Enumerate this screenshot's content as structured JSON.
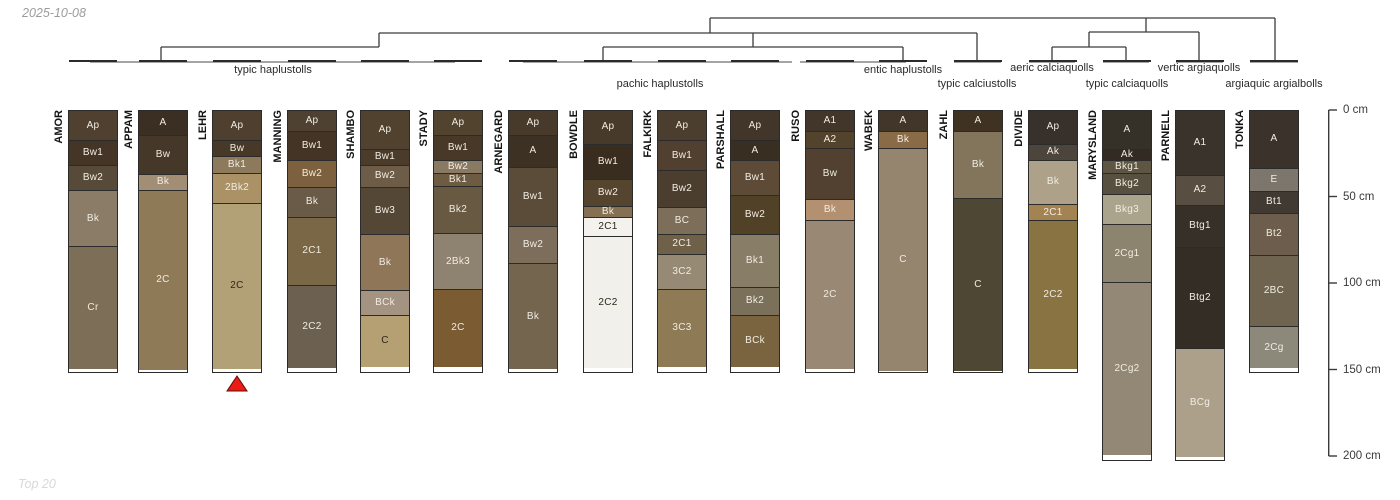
{
  "meta": {
    "date": "2025-10-08",
    "footer": "Top 20"
  },
  "marker": {
    "profile": "LEHR",
    "fill": "#ea1c13",
    "stroke": "#600d05"
  },
  "dendrogram": {
    "line_color": "#3c3c3c",
    "bracket_color": "#858585",
    "leaf_tick_color": "#2b2b2b",
    "labels": [
      {
        "text": "typic haplustolls",
        "x": 273,
        "y": 64
      },
      {
        "text": "pachic haplustolls",
        "x": 660,
        "y": 78
      },
      {
        "text": "entic haplustolls",
        "x": 903,
        "y": 64
      },
      {
        "text": "typic calciustolls",
        "x": 977,
        "y": 78
      },
      {
        "text": "aeric calciaquolls",
        "x": 1052,
        "y": 62
      },
      {
        "text": "typic calciaquolls",
        "x": 1127,
        "y": 78
      },
      {
        "text": "vertic argiaquolls",
        "x": 1199,
        "y": 62
      },
      {
        "text": "argiaquic argialbolls",
        "x": 1274,
        "y": 78
      }
    ],
    "segments": [
      [
        161,
        61,
        161,
        47
      ],
      [
        161,
        47,
        379,
        47
      ],
      [
        379,
        47,
        379,
        33
      ],
      [
        379,
        33,
        977,
        33
      ],
      [
        710,
        33,
        710,
        18
      ],
      [
        710,
        18,
        1275,
        18
      ],
      [
        1275,
        18,
        1275,
        61
      ],
      [
        603,
        61,
        603,
        47
      ],
      [
        603,
        47,
        903,
        47
      ],
      [
        903,
        47,
        903,
        61
      ],
      [
        753,
        47,
        753,
        33
      ],
      [
        977,
        33,
        977,
        61
      ],
      [
        1146,
        32,
        1146,
        18
      ],
      [
        1089,
        32,
        1199,
        32
      ],
      [
        1089,
        47,
        1089,
        32
      ],
      [
        1052,
        47,
        1126,
        47
      ],
      [
        1052,
        47,
        1052,
        61
      ],
      [
        1126,
        47,
        1126,
        61
      ],
      [
        1199,
        32,
        1199,
        61
      ]
    ],
    "brackets": [
      [
        90,
        455
      ],
      [
        523,
        792
      ],
      [
        800,
        906
      ],
      [
        954,
        1001
      ],
      [
        1029,
        1075
      ],
      [
        1103,
        1149
      ],
      [
        1176,
        1223
      ],
      [
        1250,
        1298
      ]
    ]
  },
  "chart_data": {
    "type": "table",
    "title": "Soil profile sketches grouped by taxonomic subgroup",
    "depth_unit": "cm",
    "depth_axis": {
      "x": 1328,
      "ticks": [
        0,
        50,
        100,
        150,
        200
      ],
      "tick_labels": [
        "0 cm",
        "50 cm",
        "100 cm",
        "150 cm",
        "200 cm"
      ],
      "max": 200
    },
    "profiles": [
      {
        "name": "AMOR",
        "x": 68,
        "taxon": "typic haplustolls",
        "horizons": [
          {
            "name": "Ap",
            "top": 0,
            "bottom": 18,
            "color": "#504030"
          },
          {
            "name": "Bw1",
            "top": 18,
            "bottom": 33,
            "color": "#453526"
          },
          {
            "name": "Bw2",
            "top": 33,
            "bottom": 48,
            "color": "#584a38"
          },
          {
            "name": "Bk",
            "top": 48,
            "bottom": 81,
            "color": "#8a7c66"
          },
          {
            "name": "Cr",
            "top": 81,
            "bottom": 152,
            "color": "#7d6e57"
          }
        ]
      },
      {
        "name": "APPAM",
        "x": 138,
        "taxon": "typic haplustolls",
        "horizons": [
          {
            "name": "A",
            "top": 0,
            "bottom": 15,
            "color": "#3a2f22"
          },
          {
            "name": "Bw",
            "top": 15,
            "bottom": 38,
            "color": "#463828"
          },
          {
            "name": "Bk",
            "top": 38,
            "bottom": 48,
            "color": "#a28e75"
          },
          {
            "name": "2C",
            "top": 48,
            "bottom": 152,
            "color": "#8f7a58"
          }
        ]
      },
      {
        "name": "LEHR",
        "x": 212,
        "taxon": "typic haplustolls",
        "horizons": [
          {
            "name": "Ap",
            "top": 0,
            "bottom": 18,
            "color": "#4e3f2f"
          },
          {
            "name": "Bw",
            "top": 18,
            "bottom": 28,
            "color": "#473827"
          },
          {
            "name": "Bk1",
            "top": 28,
            "bottom": 38,
            "color": "#8d7a5c"
          },
          {
            "name": "2Bk2",
            "top": 38,
            "bottom": 56,
            "color": "#ab9166"
          },
          {
            "name": "2C",
            "top": 56,
            "bottom": 152,
            "color": "#b2a076",
            "dark_label": true
          }
        ]
      },
      {
        "name": "MANNING",
        "x": 287,
        "taxon": "typic haplustolls",
        "horizons": [
          {
            "name": "Ap",
            "top": 0,
            "bottom": 13,
            "color": "#4f4132"
          },
          {
            "name": "Bw1",
            "top": 13,
            "bottom": 30,
            "color": "#443425"
          },
          {
            "name": "Bw2",
            "top": 30,
            "bottom": 46,
            "color": "#7d603e"
          },
          {
            "name": "Bk",
            "top": 46,
            "bottom": 64,
            "color": "#695b48"
          },
          {
            "name": "2C1",
            "top": 64,
            "bottom": 104,
            "color": "#7a6745"
          },
          {
            "name": "2C2",
            "top": 104,
            "bottom": 152,
            "color": "#6c6150"
          }
        ]
      },
      {
        "name": "SHAMBO",
        "x": 360,
        "taxon": "typic haplustolls",
        "horizons": [
          {
            "name": "Ap",
            "top": 0,
            "bottom": 23,
            "color": "#51422f"
          },
          {
            "name": "Bw1",
            "top": 23,
            "bottom": 33,
            "color": "#4a3b2a"
          },
          {
            "name": "Bw2",
            "top": 33,
            "bottom": 46,
            "color": "#6d5c47"
          },
          {
            "name": "Bw3",
            "top": 46,
            "bottom": 74,
            "color": "#554735"
          },
          {
            "name": "Bk",
            "top": 74,
            "bottom": 107,
            "color": "#8f7659"
          },
          {
            "name": "BCk",
            "top": 107,
            "bottom": 122,
            "color": "#a39380"
          },
          {
            "name": "C",
            "top": 122,
            "bottom": 152,
            "color": "#b5a073",
            "dark_label": true
          }
        ]
      },
      {
        "name": "STADY",
        "x": 433,
        "taxon": "typic haplustolls",
        "horizons": [
          {
            "name": "Ap",
            "top": 0,
            "bottom": 15,
            "color": "#52432f"
          },
          {
            "name": "Bw1",
            "top": 15,
            "bottom": 30,
            "color": "#483827"
          },
          {
            "name": "Bw2",
            "top": 30,
            "bottom": 38,
            "color": "#8a7a63"
          },
          {
            "name": "Bk1",
            "top": 38,
            "bottom": 46,
            "color": "#6d5c41"
          },
          {
            "name": "Bk2",
            "top": 46,
            "bottom": 74,
            "color": "#675942"
          },
          {
            "name": "2Bk3",
            "top": 74,
            "bottom": 107,
            "color": "#8e8270"
          },
          {
            "name": "2C",
            "top": 107,
            "bottom": 152,
            "color": "#7b5c32"
          }
        ]
      },
      {
        "name": "ARNEGARD",
        "x": 508,
        "taxon": "pachic haplustolls",
        "horizons": [
          {
            "name": "Ap",
            "top": 0,
            "bottom": 15,
            "color": "#473a2b"
          },
          {
            "name": "A",
            "top": 15,
            "bottom": 34,
            "color": "#3c3123"
          },
          {
            "name": "Bw1",
            "top": 34,
            "bottom": 69,
            "color": "#5b4c39"
          },
          {
            "name": "Bw2",
            "top": 69,
            "bottom": 91,
            "color": "#7d6e5c"
          },
          {
            "name": "Bk",
            "top": 91,
            "bottom": 152,
            "color": "#73654e"
          }
        ]
      },
      {
        "name": "BOWDLE",
        "x": 583,
        "taxon": "pachic haplustolls",
        "horizons": [
          {
            "name": "Ap",
            "top": 0,
            "bottom": 20,
            "color": "#483a2b"
          },
          {
            "name": "Bw1",
            "top": 20,
            "bottom": 41,
            "color": "#392d1f"
          },
          {
            "name": "Bw2",
            "top": 41,
            "bottom": 57,
            "color": "#55452f"
          },
          {
            "name": "Bk",
            "top": 57,
            "bottom": 64,
            "color": "#857053"
          },
          {
            "name": "2C1",
            "top": 64,
            "bottom": 76,
            "color": "#f4f2ee",
            "dark_label": true
          },
          {
            "name": "2C2",
            "top": 76,
            "bottom": 152,
            "color": "#f2f0eb",
            "dark_label": true
          }
        ]
      },
      {
        "name": "FALKIRK",
        "x": 657,
        "taxon": "pachic haplustolls",
        "horizons": [
          {
            "name": "Ap",
            "top": 0,
            "bottom": 18,
            "color": "#4c3e2e"
          },
          {
            "name": "Bw1",
            "top": 18,
            "bottom": 36,
            "color": "#514030"
          },
          {
            "name": "Bw2",
            "top": 36,
            "bottom": 58,
            "color": "#4c3e2f"
          },
          {
            "name": "BC",
            "top": 58,
            "bottom": 74,
            "color": "#7c6e59"
          },
          {
            "name": "2C1",
            "top": 74,
            "bottom": 86,
            "color": "#6f6148"
          },
          {
            "name": "3C2",
            "top": 86,
            "bottom": 107,
            "color": "#968a74"
          },
          {
            "name": "3C3",
            "top": 107,
            "bottom": 152,
            "color": "#8e7a55"
          }
        ]
      },
      {
        "name": "PARSHALL",
        "x": 730,
        "taxon": "pachic haplustolls",
        "horizons": [
          {
            "name": "Ap",
            "top": 0,
            "bottom": 18,
            "color": "#42352a"
          },
          {
            "name": "A",
            "top": 18,
            "bottom": 30,
            "color": "#392e22"
          },
          {
            "name": "Bw1",
            "top": 30,
            "bottom": 51,
            "color": "#5d4b37"
          },
          {
            "name": "Bw2",
            "top": 51,
            "bottom": 74,
            "color": "#514126"
          },
          {
            "name": "Bk1",
            "top": 74,
            "bottom": 105,
            "color": "#887d67"
          },
          {
            "name": "Bk2",
            "top": 105,
            "bottom": 122,
            "color": "#7b7059"
          },
          {
            "name": "BCk",
            "top": 122,
            "bottom": 152,
            "color": "#7a6440"
          }
        ]
      },
      {
        "name": "RUSO",
        "x": 805,
        "taxon": "entic haplustolls",
        "horizons": [
          {
            "name": "A1",
            "top": 0,
            "bottom": 13,
            "color": "#42352a"
          },
          {
            "name": "A2",
            "top": 13,
            "bottom": 23,
            "color": "#53432d"
          },
          {
            "name": "Bw",
            "top": 23,
            "bottom": 53,
            "color": "#524130"
          },
          {
            "name": "Bk",
            "top": 53,
            "bottom": 66,
            "color": "#b29070"
          },
          {
            "name": "2C",
            "top": 66,
            "bottom": 152,
            "color": "#988874"
          }
        ]
      },
      {
        "name": "WABEK",
        "x": 878,
        "taxon": "entic haplustolls",
        "horizons": [
          {
            "name": "A",
            "top": 0,
            "bottom": 13,
            "color": "#42352a"
          },
          {
            "name": "Bk",
            "top": 13,
            "bottom": 23,
            "color": "#8a6b47"
          },
          {
            "name": "C",
            "top": 23,
            "bottom": 152,
            "color": "#95856f"
          }
        ]
      },
      {
        "name": "ZAHL",
        "x": 953,
        "taxon": "typic calciustolls",
        "horizons": [
          {
            "name": "A",
            "top": 0,
            "bottom": 13,
            "color": "#3f3222"
          },
          {
            "name": "Bk",
            "top": 13,
            "bottom": 52,
            "color": "#82755c"
          },
          {
            "name": "C",
            "top": 52,
            "bottom": 152,
            "color": "#4e4733"
          }
        ]
      },
      {
        "name": "DIVIDE",
        "x": 1028,
        "taxon": "aeric calciaquolls",
        "horizons": [
          {
            "name": "Ap",
            "top": 0,
            "bottom": 20,
            "color": "#38302a"
          },
          {
            "name": "Ak",
            "top": 20,
            "bottom": 30,
            "color": "#4c453c"
          },
          {
            "name": "Bk",
            "top": 30,
            "bottom": 56,
            "color": "#ada289"
          },
          {
            "name": "2C1",
            "top": 56,
            "bottom": 66,
            "color": "#a48353"
          },
          {
            "name": "2C2",
            "top": 66,
            "bottom": 152,
            "color": "#8a7342"
          }
        ]
      },
      {
        "name": "MARYSLAND",
        "x": 1102,
        "taxon": "typic calciaquolls",
        "horizons": [
          {
            "name": "A",
            "top": 0,
            "bottom": 23,
            "color": "#353028"
          },
          {
            "name": "Ak",
            "top": 23,
            "bottom": 30,
            "color": "#322b23"
          },
          {
            "name": "Bkg1",
            "top": 30,
            "bottom": 38,
            "color": "#5e5542"
          },
          {
            "name": "Bkg2",
            "top": 38,
            "bottom": 51,
            "color": "#575040"
          },
          {
            "name": "Bkg3",
            "top": 51,
            "bottom": 69,
            "color": "#aaa48c"
          },
          {
            "name": "2Cg1",
            "top": 69,
            "bottom": 103,
            "color": "#8d8470"
          },
          {
            "name": "2Cg2",
            "top": 103,
            "bottom": 203,
            "color": "#928875"
          }
        ]
      },
      {
        "name": "PARNELL",
        "x": 1175,
        "taxon": "vertic argiaquolls",
        "horizons": [
          {
            "name": "A1",
            "top": 0,
            "bottom": 38,
            "color": "#3a332c"
          },
          {
            "name": "A2",
            "top": 38,
            "bottom": 56,
            "color": "#584e42"
          },
          {
            "name": "Btg1",
            "top": 56,
            "bottom": 81,
            "color": "#373029"
          },
          {
            "name": "Btg2",
            "top": 81,
            "bottom": 140,
            "color": "#332d26"
          },
          {
            "name": "BCg",
            "top": 140,
            "bottom": 203,
            "color": "#aca08b"
          }
        ]
      },
      {
        "name": "TONKA",
        "x": 1249,
        "taxon": "argiaquic argialbolls",
        "horizons": [
          {
            "name": "A",
            "top": 0,
            "bottom": 34,
            "color": "#3b332b"
          },
          {
            "name": "E",
            "top": 34,
            "bottom": 48,
            "color": "#7d766c"
          },
          {
            "name": "Bt1",
            "top": 48,
            "bottom": 61,
            "color": "#413a32"
          },
          {
            "name": "Bt2",
            "top": 61,
            "bottom": 86,
            "color": "#6c5d4c"
          },
          {
            "name": "2BC",
            "top": 86,
            "bottom": 128,
            "color": "#6f6450"
          },
          {
            "name": "2Cg",
            "top": 128,
            "bottom": 152,
            "color": "#8c887a"
          }
        ]
      }
    ]
  }
}
